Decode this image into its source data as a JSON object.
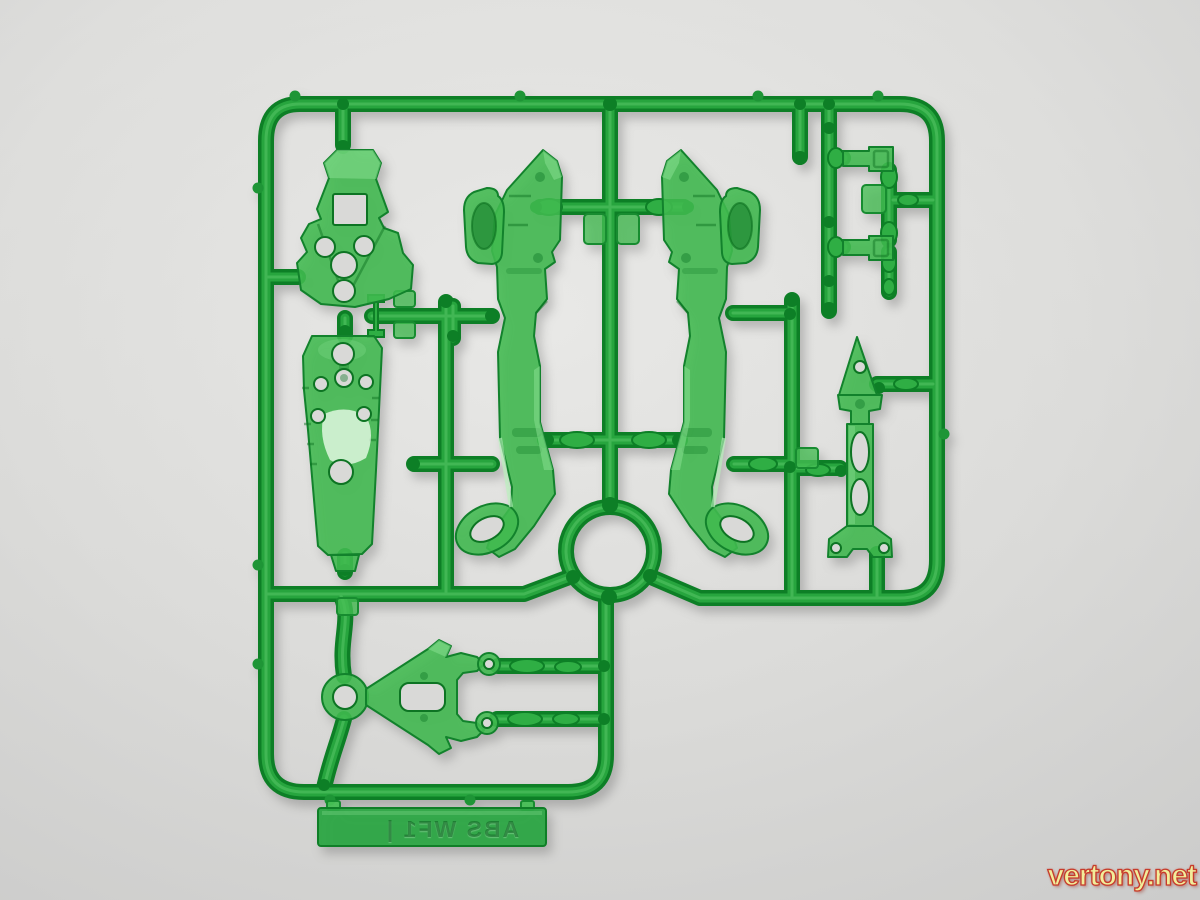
{
  "scene": {
    "type": "photograph",
    "subject": "Translucent green plastic model-kit runner (sprue) with molded armor parts, photographed flat on a light gray surface",
    "background_color": "#dcdcda"
  },
  "sprue": {
    "runner_color": "#27a53e",
    "part_color": "#41bb50",
    "edge_color": "#0d7f26",
    "molded_label": {
      "text": "ABS WF1 |",
      "mirrored": true
    },
    "parts": [
      "chest-armor-plate",
      "core-shield-plate",
      "side-armor-left",
      "side-armor-right",
      "stabilizer-fin",
      "connector-yoke",
      "latch-key-upper",
      "latch-key-lower",
      "gate-ring",
      "material-tab"
    ]
  },
  "watermark": {
    "text": "vertony.net",
    "fill_color": "#f1ee9b",
    "outline_color": "#c73b2b"
  }
}
